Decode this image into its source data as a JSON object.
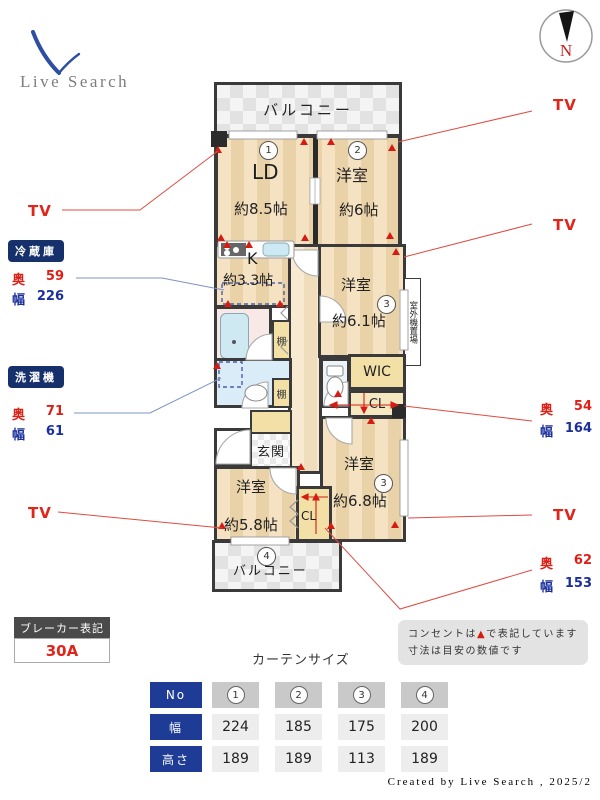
{
  "logo": {
    "text": "Live Search"
  },
  "compass": {
    "label": "N"
  },
  "floorplan": {
    "balcony_top_label": "バルコニー",
    "balcony_bottom_label": "バルコニー",
    "balcony_bottom_no": "4",
    "ld": {
      "no": "1",
      "name": "LD",
      "size": "約8.5帖"
    },
    "bedroom_a": {
      "no": "2",
      "name": "洋室",
      "size": "約6帖"
    },
    "kitchen": {
      "name": "K",
      "size": "約3.3帖"
    },
    "bedroom_b": {
      "no": "3",
      "name": "洋室",
      "size": "約6.1帖"
    },
    "bedroom_c": {
      "no": "3",
      "name": "洋室",
      "size": "約6.8帖"
    },
    "bedroom_d": {
      "name": "洋室",
      "size": "約5.8帖"
    },
    "wic_label": "WIC",
    "closet_mid_label": "CL",
    "closet_bottom_label": "CL",
    "entrance_label": "玄関",
    "shelf_label": "棚",
    "outdoor_unit_label": "室外機置場"
  },
  "side_labels": {
    "tv": "TV",
    "depth_label": "奥",
    "width_label": "幅",
    "fridge": {
      "title": "冷蔵庫",
      "depth": "59",
      "width": "226"
    },
    "washer": {
      "title": "洗濯機",
      "depth": "71",
      "width": "61"
    },
    "closet_mid": {
      "depth": "54",
      "width": "164"
    },
    "closet_bottom": {
      "depth": "62",
      "width": "153"
    }
  },
  "breaker": {
    "title": "ブレーカー表記",
    "value": "30A"
  },
  "curtain": {
    "title": "カーテンサイズ",
    "row_headers": [
      "No",
      "幅",
      "高さ"
    ],
    "columns": [
      {
        "no": "1",
        "width": "224",
        "height": "189"
      },
      {
        "no": "2",
        "width": "185",
        "height": "189"
      },
      {
        "no": "3",
        "width": "175",
        "height": "113"
      },
      {
        "no": "4",
        "width": "200",
        "height": "189"
      }
    ]
  },
  "notes": {
    "line1_pre": "コンセントは",
    "line1_marker": "▲",
    "line1_post": "で表記しています",
    "line2": "寸法は目安の数値です"
  },
  "footer": {
    "credit": "Created by Live Search , 2025/2"
  },
  "colors": {
    "accent_red": "#dd2016",
    "accent_blue": "#1b2f9b",
    "badge_navy": "#16306b",
    "table_navy": "#1e3c96",
    "wall": "#3a3a3a",
    "floor_beige": "#f2dfc0",
    "leader_red": "#df4b42",
    "leader_blue": "#7e93c4"
  }
}
